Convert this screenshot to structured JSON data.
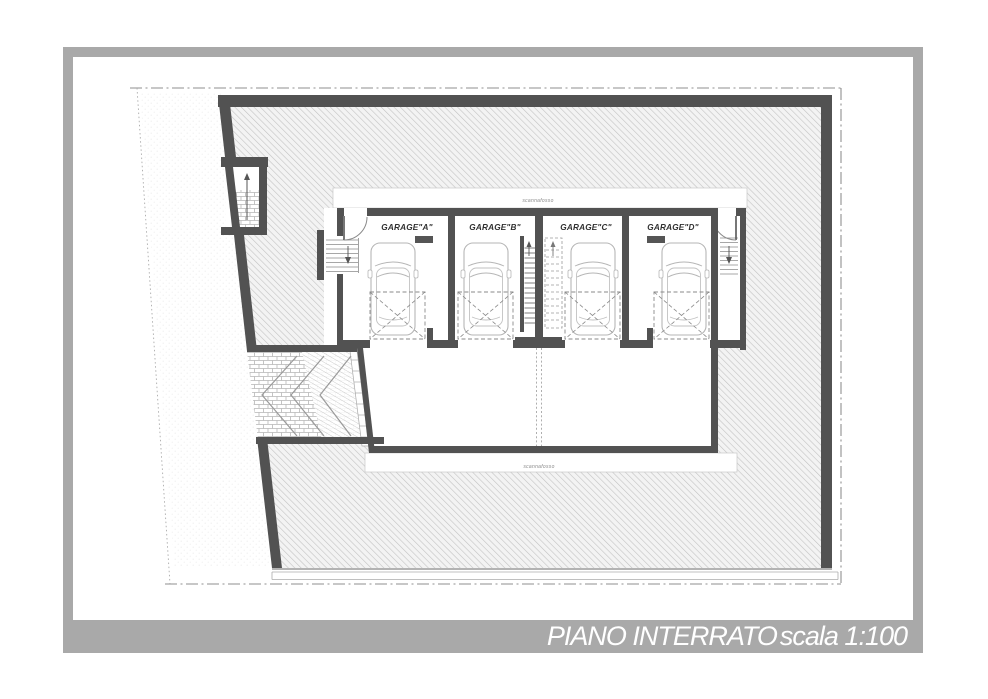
{
  "page": {
    "background": "#ffffff",
    "frame_color": "#a9a9a9"
  },
  "title_block": {
    "plan_name": "PIANO INTERRATO",
    "scale_label": "scala 1:100",
    "text_color": "#ffffff"
  },
  "annotations": {
    "moat_label_top": "scannafosso",
    "moat_label_bottom": "scannafosso"
  },
  "garages": {
    "a": "GARAGE\"A\"",
    "b": "GARAGE\"B\"",
    "c": "GARAGE\"C\"",
    "d": "GARAGE\"D\""
  },
  "drawing_colors": {
    "wall": "#525252",
    "hatch_line": "#c3c3c3",
    "hatch_bg": "#f3f3f3",
    "boundary_line": "#8f8f8f",
    "car_outline": "#b6b6b6",
    "parking_dash": "#8a8a8a"
  }
}
